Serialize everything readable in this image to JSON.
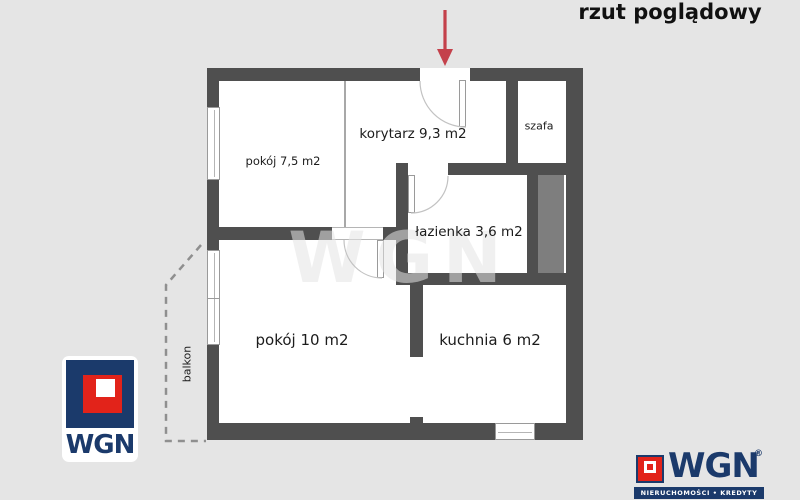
{
  "title": "rzut poglądowy",
  "plan": {
    "rooms": [
      {
        "id": "pokoj-75",
        "label": "pokój 7,5 m2"
      },
      {
        "id": "korytarz",
        "label": "korytarz 9,3 m2"
      },
      {
        "id": "szafa",
        "label": "szafa"
      },
      {
        "id": "lazienka",
        "label": "łazienka 3,6 m2"
      },
      {
        "id": "pokoj-10",
        "label": "pokój 10 m2"
      },
      {
        "id": "kuchnia",
        "label": "kuchnia 6 m2"
      },
      {
        "id": "balkon",
        "label": "balkon"
      }
    ],
    "watermark": "WGN"
  },
  "colors": {
    "background": "#e5e5e5",
    "wall": "#4f4f4f",
    "shaft": "#7e7e7e",
    "arrow_red": "#c4414b",
    "brand_navy": "#1b3a6b",
    "brand_red": "#e2231a"
  },
  "branding": {
    "logo_left": {
      "text": "WGN"
    },
    "logo_right": {
      "text": "WGN",
      "registered": "®",
      "tagline": "NIERUCHOMOŚCI • KREDYTY"
    }
  }
}
